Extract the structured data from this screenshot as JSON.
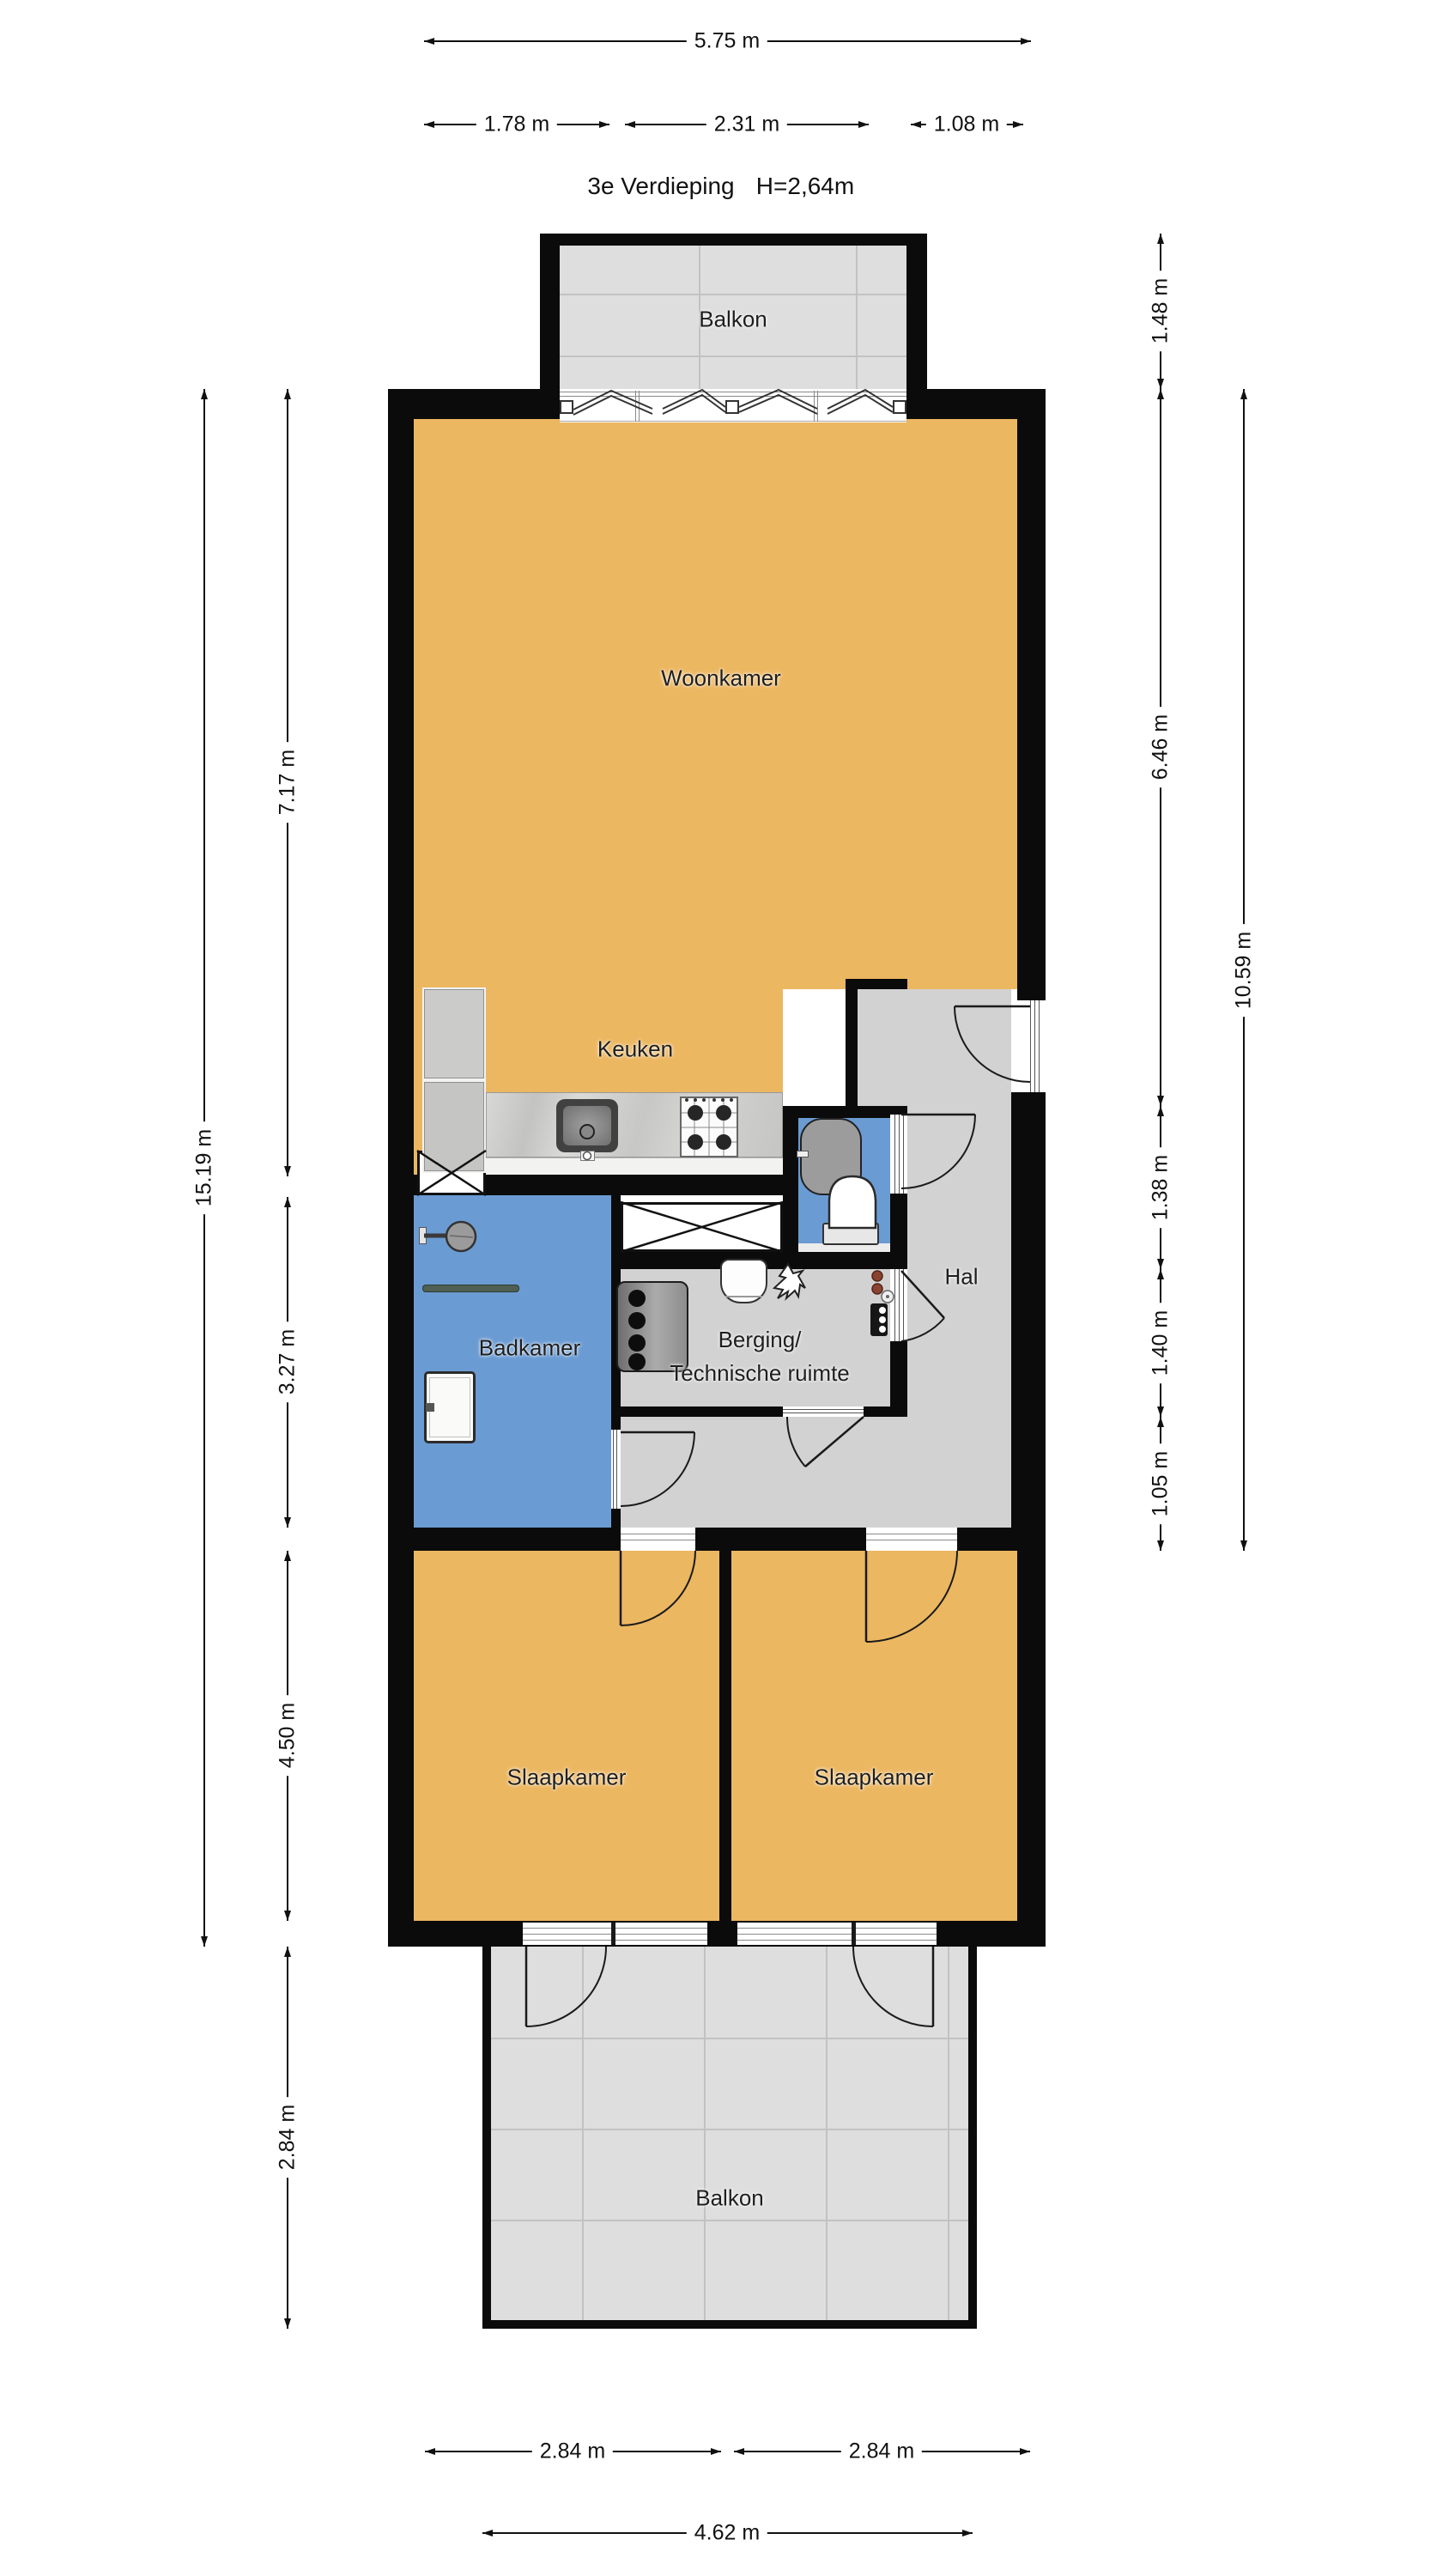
{
  "title": {
    "floor": "3e Verdieping",
    "ceiling_height": "H=2,64m"
  },
  "rooms": {
    "balkon_top": "Balkon",
    "woonkamer": "Woonkamer",
    "keuken": "Keuken",
    "badkamer": "Badkamer",
    "hal": "Hal",
    "berging_line1": "Berging/",
    "berging_line2": "Technische ruimte",
    "slaapkamer_left": "Slaapkamer",
    "slaapkamer_right": "Slaapkamer",
    "balkon_bottom": "Balkon"
  },
  "dimensions": {
    "top_total": "5.75 m",
    "top_left": "1.78 m",
    "top_middle": "2.31 m",
    "top_right": "1.08 m",
    "right_balcony": "1.48 m",
    "right_living": "6.46 m",
    "right_total": "10.59 m",
    "right_toilet": "1.38 m",
    "right_storage": "1.40 m",
    "right_hall": "1.05 m",
    "left_total": "15.19 m",
    "left_living": "7.17 m",
    "left_bathroom": "3.27 m",
    "left_bedrooms": "4.50 m",
    "left_balcony": "2.84 m",
    "bottom_bedroom_left": "2.84 m",
    "bottom_bedroom_right": "2.84 m",
    "bottom_balcony": "4.62 m"
  },
  "colors": {
    "wall_black": "#0b0b0b",
    "room_orange": "#ECB761",
    "room_blue": "#6B9BD3",
    "floor_gray": "#D2D2D2",
    "tile_gray": "#DEDEDE",
    "shelf_gray": "#ECECEC"
  }
}
